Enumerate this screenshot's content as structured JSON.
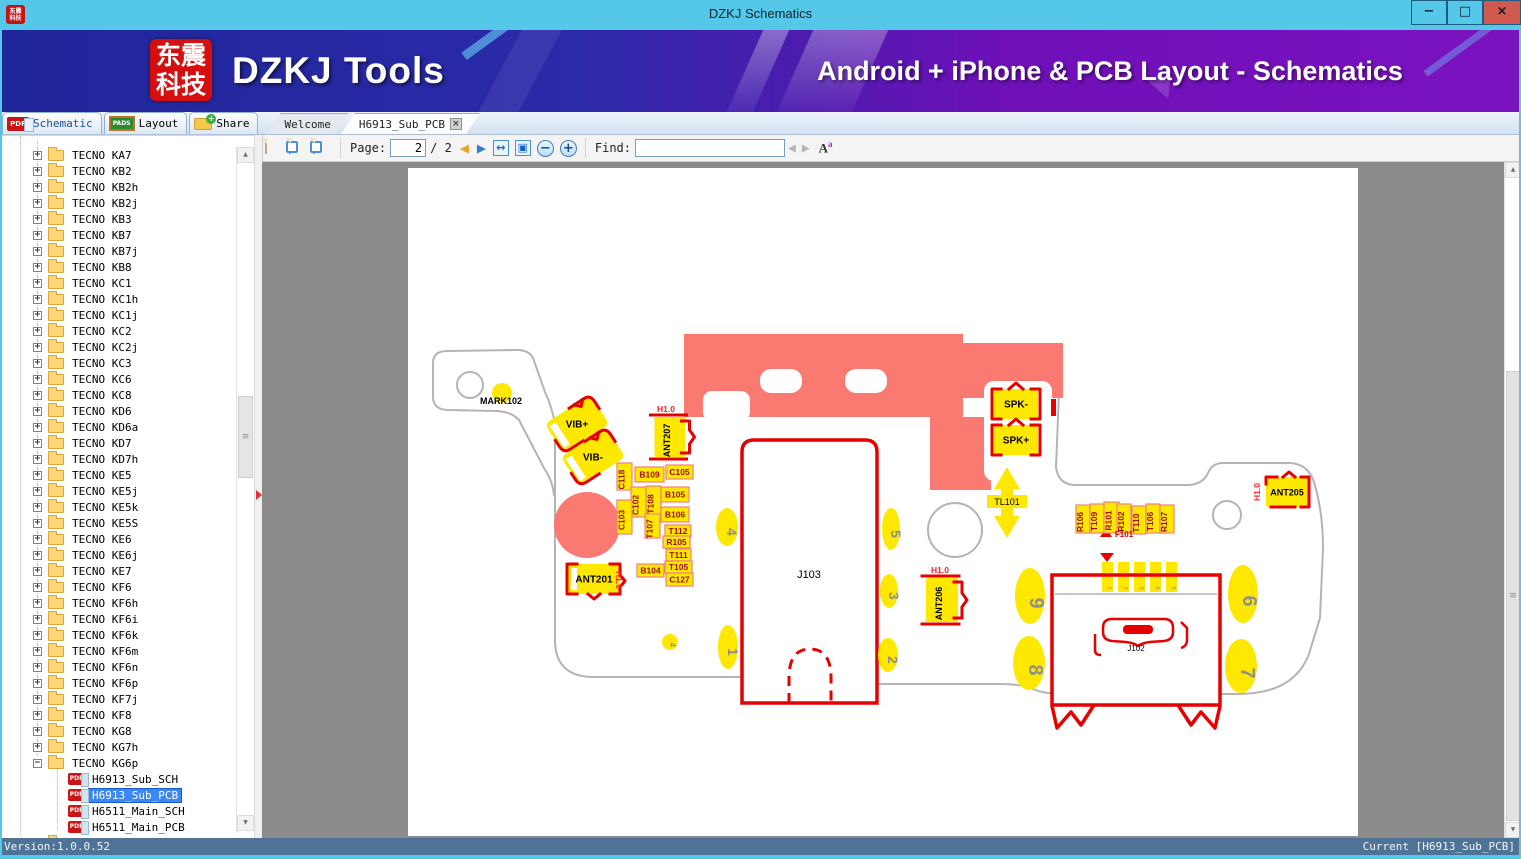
{
  "titlebar": {
    "title": "DZKJ Schematics",
    "icon_lines": [
      "东震",
      "科技"
    ],
    "controls": {
      "minimize": "−",
      "maximize": "□",
      "close": "×"
    }
  },
  "banner": {
    "logo_lines": [
      "东震",
      "科技"
    ],
    "app_name": "DZKJ Tools",
    "tagline": "Android + iPhone & PCB Layout - Schematics"
  },
  "tabs": {
    "tool": [
      {
        "label": "Schematic",
        "badge": "PDF"
      },
      {
        "label": "Layout",
        "badge": "PADS"
      },
      {
        "label": "Share",
        "badge": ""
      }
    ],
    "docs": [
      {
        "label": "Welcome",
        "active": false,
        "closable": false
      },
      {
        "label": "H6913_Sub_PCB",
        "active": true,
        "closable": true,
        "close_glyph": "×"
      }
    ]
  },
  "toolbar": {
    "page_label": "Page:",
    "page_value": "2",
    "page_total": "/ 2",
    "find_label": "Find:",
    "find_value": "",
    "icons": {
      "prev": "◀",
      "next": "▶",
      "fit_width": "↔",
      "fit_page": "▣",
      "zoom_out": "−",
      "zoom_in": "+",
      "find_prev": "◀",
      "find_next": "▶",
      "font_big": "A",
      "font_small": "a",
      "scroll_up": "▲",
      "scroll_down": "▼"
    }
  },
  "tree": {
    "pdf_badge": "PDF",
    "items": [
      {
        "label": "TECNO KA7"
      },
      {
        "label": "TECNO KB2"
      },
      {
        "label": "TECNO KB2h"
      },
      {
        "label": "TECNO KB2j"
      },
      {
        "label": "TECNO KB3"
      },
      {
        "label": "TECNO KB7"
      },
      {
        "label": "TECNO KB7j"
      },
      {
        "label": "TECNO KB8"
      },
      {
        "label": "TECNO KC1"
      },
      {
        "label": "TECNO KC1h"
      },
      {
        "label": "TECNO KC1j"
      },
      {
        "label": "TECNO KC2"
      },
      {
        "label": "TECNO KC2j"
      },
      {
        "label": "TECNO KC3"
      },
      {
        "label": "TECNO KC6"
      },
      {
        "label": "TECNO KC8"
      },
      {
        "label": "TECNO KD6"
      },
      {
        "label": "TECNO KD6a"
      },
      {
        "label": "TECNO KD7"
      },
      {
        "label": "TECNO KD7h"
      },
      {
        "label": "TECNO KE5"
      },
      {
        "label": "TECNO KE5j"
      },
      {
        "label": "TECNO KE5k"
      },
      {
        "label": "TECNO KE5S"
      },
      {
        "label": "TECNO KE6"
      },
      {
        "label": "TECNO KE6j"
      },
      {
        "label": "TECNO KE7"
      },
      {
        "label": "TECNO KF6"
      },
      {
        "label": "TECNO KF6h"
      },
      {
        "label": "TECNO KF6i"
      },
      {
        "label": "TECNO KF6k"
      },
      {
        "label": "TECNO KF6m"
      },
      {
        "label": "TECNO KF6n"
      },
      {
        "label": "TECNO KF6p"
      },
      {
        "label": "TECNO KF7j"
      },
      {
        "label": "TECNO KF8"
      },
      {
        "label": "TECNO KG8"
      },
      {
        "label": "TECNO KG7h"
      },
      {
        "label": "TECNO KG6p",
        "expanded": true,
        "children": [
          {
            "label": "H6913_Sub_SCH"
          },
          {
            "label": "H6913_Sub_PCB",
            "selected": true
          },
          {
            "label": "H6511_Main_SCH"
          },
          {
            "label": "H6511_Main_PCB"
          }
        ]
      },
      {
        "label": "",
        "partial": true
      }
    ]
  },
  "statusbar": {
    "left": "Version:1.0.0.52",
    "right": "Current [H6913_Sub_PCB]"
  },
  "pcb": {
    "colors": {
      "pad_yellow": "#ffe800",
      "plane_red": "#fa7a72",
      "outline_red": "#e60000",
      "board_gray": "#b4b4b4",
      "label_border": "#f08080",
      "label_text": "#a01010",
      "h10_red": "#ff2020",
      "digit_gray": "#8f8f8f"
    },
    "h10_text": "H1.0",
    "h10_labels": [
      {
        "x": 666,
        "y": 412,
        "rot": 0
      },
      {
        "x": 616,
        "y": 580,
        "rot": 90
      },
      {
        "x": 940,
        "y": 573,
        "rot": 0
      },
      {
        "x": 1260,
        "y": 492,
        "rot": -90
      }
    ],
    "ref_labels": [
      {
        "text": "C118",
        "x": 617,
        "y": 463,
        "w": 15,
        "h": 27,
        "vert": true
      },
      {
        "text": "B109",
        "x": 635,
        "y": 467,
        "w": 29,
        "h": 15
      },
      {
        "text": "C105",
        "x": 666,
        "y": 465,
        "w": 27,
        "h": 14
      },
      {
        "text": "C102",
        "x": 631,
        "y": 487,
        "w": 15,
        "h": 30,
        "vert": true
      },
      {
        "text": "T108",
        "x": 646,
        "y": 486,
        "w": 15,
        "h": 30,
        "vert": true
      },
      {
        "text": "C103",
        "x": 617,
        "y": 500,
        "w": 15,
        "h": 34,
        "vert": true
      },
      {
        "text": "T107",
        "x": 645,
        "y": 514,
        "w": 15,
        "h": 24,
        "vert": true
      },
      {
        "text": "B105",
        "x": 661,
        "y": 487,
        "w": 28,
        "h": 15
      },
      {
        "text": "B106",
        "x": 661,
        "y": 507,
        "w": 28,
        "h": 15
      },
      {
        "text": "T112",
        "x": 665,
        "y": 525,
        "w": 26,
        "h": 12
      },
      {
        "text": "R105",
        "x": 663,
        "y": 536,
        "w": 27,
        "h": 12
      },
      {
        "text": "T111",
        "x": 666,
        "y": 549,
        "w": 25,
        "h": 12
      },
      {
        "text": "T105",
        "x": 665,
        "y": 561,
        "w": 27,
        "h": 12
      },
      {
        "text": "C127",
        "x": 666,
        "y": 573,
        "w": 27,
        "h": 13
      },
      {
        "text": "B104",
        "x": 637,
        "y": 564,
        "w": 27,
        "h": 13
      },
      {
        "text": "R106",
        "x": 1076,
        "y": 505,
        "w": 14,
        "h": 28,
        "vert": true
      },
      {
        "text": "T109",
        "x": 1090,
        "y": 504,
        "w": 14,
        "h": 29,
        "vert": true
      },
      {
        "text": "R101",
        "x": 1104,
        "y": 502,
        "w": 15,
        "h": 31,
        "vert": true
      },
      {
        "text": "R102",
        "x": 1117,
        "y": 504,
        "w": 14,
        "h": 29,
        "vert": true
      },
      {
        "text": "T110",
        "x": 1132,
        "y": 506,
        "w": 14,
        "h": 28,
        "vert": true
      },
      {
        "text": "T106",
        "x": 1146,
        "y": 504,
        "w": 14,
        "h": 29,
        "vert": true
      },
      {
        "text": "R107",
        "x": 1160,
        "y": 505,
        "w": 14,
        "h": 28,
        "vert": true
      }
    ],
    "pads": [
      {
        "text": "VIB+",
        "cx": 577,
        "cy": 424,
        "w": 54,
        "h": 35,
        "rot": -33,
        "style": "vib",
        "ts": 10
      },
      {
        "text": "VIB-",
        "cx": 593,
        "cy": 457,
        "w": 54,
        "h": 35,
        "rot": -33,
        "style": "vib",
        "ts": 10
      },
      {
        "text": "ANT207",
        "cx": 670,
        "cy": 437,
        "w": 31,
        "h": 40,
        "style": "antv",
        "text_rot": -90,
        "ts": 9
      },
      {
        "text": "ANT201",
        "cx": 594,
        "cy": 579,
        "w": 52,
        "h": 30,
        "style": "anth",
        "ts": 10
      },
      {
        "text": "ANT206",
        "cx": 942,
        "cy": 600,
        "w": 32,
        "h": 44,
        "style": "antv",
        "text_rot": -90,
        "ts": 9
      },
      {
        "text": "ANT205",
        "cx": 1287,
        "cy": 492,
        "w": 42,
        "h": 30,
        "style": "ant205",
        "ts": 9
      },
      {
        "text": "SPK-",
        "cx": 1016,
        "cy": 404,
        "w": 44,
        "h": 30,
        "style": "spk",
        "ts": 10
      },
      {
        "text": "SPK+",
        "cx": 1016,
        "cy": 440,
        "w": 44,
        "h": 30,
        "style": "spk",
        "ts": 10
      }
    ],
    "number_ovals": [
      {
        "text": "4",
        "cx": 727,
        "cy": 527,
        "rx": 11,
        "ry": 19,
        "fs": 14
      },
      {
        "text": "1",
        "cx": 728,
        "cy": 647,
        "rx": 10,
        "ry": 22,
        "fs": 14
      },
      {
        "text": "5",
        "cx": 891,
        "cy": 529,
        "rx": 9,
        "ry": 21,
        "fs": 14
      },
      {
        "text": "3",
        "cx": 889,
        "cy": 591,
        "rx": 9,
        "ry": 17,
        "fs": 14
      },
      {
        "text": "2",
        "cx": 888,
        "cy": 655,
        "rx": 10,
        "ry": 17,
        "fs": 14
      },
      {
        "text": "9",
        "cx": 1030,
        "cy": 596,
        "rx": 15,
        "ry": 28,
        "fs": 20
      },
      {
        "text": "8",
        "cx": 1029,
        "cy": 663,
        "rx": 16,
        "ry": 27,
        "fs": 20
      },
      {
        "text": "6",
        "cx": 1243,
        "cy": 594,
        "rx": 15,
        "ry": 29,
        "fs": 20
      },
      {
        "text": "7",
        "cx": 1241,
        "cy": 666,
        "rx": 16,
        "ry": 27,
        "fs": 20
      },
      {
        "text": "4",
        "cx": 670,
        "cy": 642,
        "rx": 8,
        "ry": 8,
        "fs": 8
      }
    ],
    "texts": [
      {
        "text": "J103",
        "x": 809,
        "y": 578,
        "fs": 11,
        "color": "#000000"
      },
      {
        "text": "J102",
        "x": 1136,
        "y": 651,
        "fs": 8,
        "color": "#000000"
      },
      {
        "text": "TL101",
        "x": 1007,
        "y": 505,
        "fs": 9,
        "color": "#000000",
        "bg": [
          987,
          495,
          40,
          13
        ]
      },
      {
        "text": "MARK102",
        "x": 501,
        "y": 404,
        "fs": 9,
        "color": "#000000",
        "bold": true
      },
      {
        "text": "F101",
        "x": 1124,
        "y": 537,
        "fs": 8,
        "color": "#e60000",
        "bold": true
      }
    ],
    "usb_pins": [
      "1",
      "2",
      "3",
      "4",
      "5"
    ]
  }
}
